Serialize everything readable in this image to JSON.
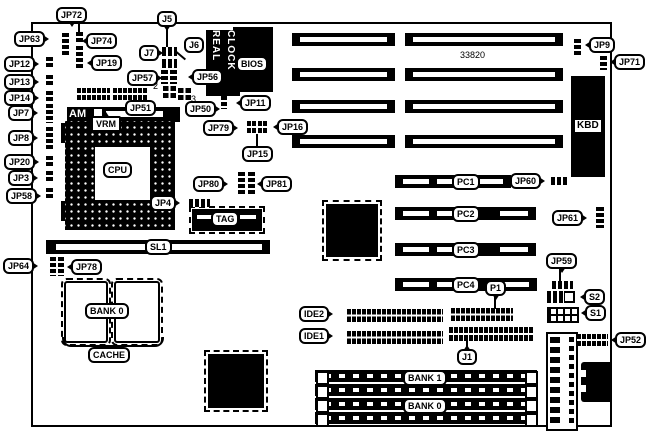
{
  "labels": {
    "jp72": "JP72",
    "jp63": "JP63",
    "jp74": "JP74",
    "jp19": "JP19",
    "jp12": "JP12",
    "jp13": "JP13",
    "jp14": "JP14",
    "jp7": "JP7",
    "jp8": "JP8",
    "jp20": "JP20",
    "jp3": "JP3",
    "jp58": "JP58",
    "j5": "J5",
    "j6": "J6",
    "j7": "J7",
    "jp57": "JP57",
    "jp56": "JP56",
    "jp51": "JP51",
    "jp50": "JP50",
    "jp11": "JP11",
    "jp79": "JP79",
    "jp16": "JP16",
    "jp15": "JP15",
    "jp80": "JP80",
    "jp81": "JP81",
    "jp4": "JP4",
    "jp9": "JP9",
    "jp71": "JP71",
    "jp60": "JP60",
    "jp61": "JP61",
    "jp59": "JP59",
    "s2": "S2",
    "s1": "S1",
    "jp52": "JP52",
    "jp64": "JP64",
    "jp78": "JP78",
    "pc1": "PC1",
    "pc2": "PC2",
    "pc3": "PC3",
    "pc4": "PC4",
    "sl1": "SL1",
    "ide2": "IDE2",
    "ide1": "IDE1",
    "p1": "P1",
    "j1": "J1",
    "bank1": "BANK 1",
    "bank0": "BANK 0",
    "cache_bank": "BANK 0",
    "cache": "CACHE"
  },
  "chips": {
    "cpu": "CPU",
    "bios": "BIOS",
    "kbd": "KBD",
    "tag": "TAG",
    "vrm": "VRM",
    "socket_brand": "AM",
    "rtc_left_word": "REAL",
    "rtc_right_word": "CLOCK",
    "asic_marking": "33820"
  },
  "pin_numbers": {
    "pin2": "2",
    "pin3": "3"
  }
}
